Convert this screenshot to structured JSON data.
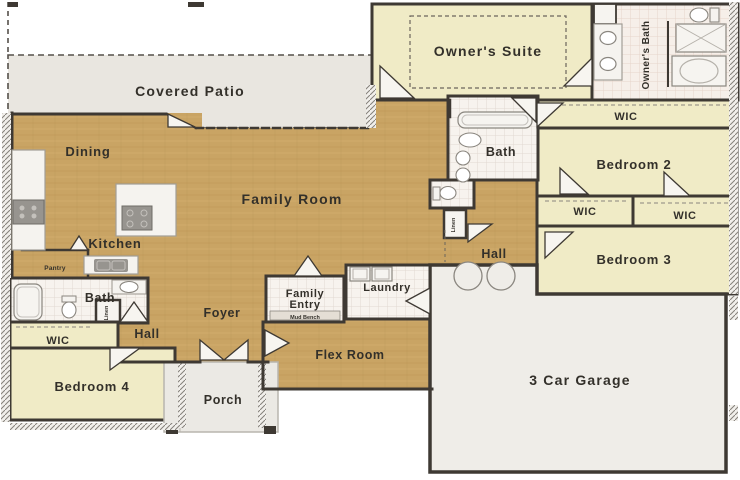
{
  "floor_plan": {
    "rooms": {
      "covered_patio": "Covered Patio",
      "dining": "Dining",
      "family_room": "Family Room",
      "kitchen": "Kitchen",
      "pantry": "Pantry",
      "owners_suite": "Owner's Suite",
      "owners_bath": "Owner's Bath",
      "wic": "WIC",
      "bedroom_2": "Bedroom 2",
      "bedroom_3": "Bedroom 3",
      "bedroom_4": "Bedroom 4",
      "bath": "Bath",
      "hall": "Hall",
      "laundry": "Laundry",
      "family_entry": {
        "line1": "Family",
        "line2": "Entry"
      },
      "mud_bench": "Mud Bench",
      "flex_room": "Flex Room",
      "foyer": "Foyer",
      "porch": "Porch",
      "garage": "3 Car Garage",
      "linen": "Linen"
    },
    "colors": {
      "wood_floor": "#c9a464",
      "carpet_cream": "#f0ebc6",
      "tile_white": "#f7f3ee",
      "patio_gray": "#e9e6e0",
      "garage_gray": "#efede8",
      "wall_dark": "#3e3933",
      "label_text": "#33302a"
    }
  }
}
